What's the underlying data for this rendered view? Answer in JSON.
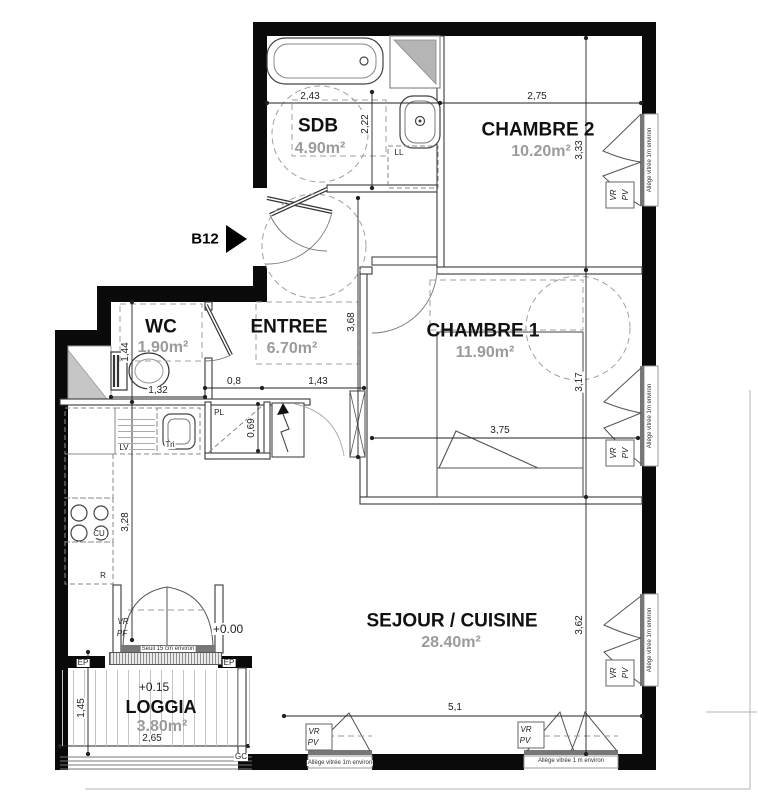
{
  "unit": {
    "label": "B12"
  },
  "rooms": {
    "sdb": {
      "name": "SDB",
      "area": "4.90m²"
    },
    "chambre2": {
      "name": "CHAMBRE 2",
      "area": "10.20m²"
    },
    "wc": {
      "name": "WC",
      "area": "1.90m²"
    },
    "entree": {
      "name": "ENTREE",
      "area": "6.70m²"
    },
    "chambre1": {
      "name": "CHAMBRE 1",
      "area": "11.90m²"
    },
    "sejour": {
      "name": "SEJOUR / CUISINE",
      "area": "28.40m²"
    },
    "loggia": {
      "name": "LOGGIA",
      "area": "3.80m²",
      "level": "+0.15"
    }
  },
  "levels": {
    "interior": "+0.00"
  },
  "dims": {
    "sdb_width": "2,43",
    "sdb_depth": "2,22",
    "ch2_width": "2,75",
    "ch2_depth": "3,33",
    "entree_depth": "3,68",
    "wc_depth": "1,44",
    "wc_width": "1,32",
    "pl_width": "0,8",
    "hall_width": "1,43",
    "pl_depth": "0,69",
    "ch1_width": "3,75",
    "ch1_depth": "3,17",
    "kitchen_depth": "3,28",
    "sejour_width": "5,1",
    "sejour_depth": "3,62",
    "loggia_depth": "1,45",
    "loggia_width": "2,65"
  },
  "equipment": {
    "washing_machine": "LL",
    "dishwasher": "LV",
    "sink": "Tri",
    "hob": "CU",
    "fridge": "R",
    "closet": "PL"
  },
  "window_labels": {
    "shutter": "VR",
    "french_door": "PF",
    "window": "PV"
  },
  "annotations": {
    "threshold": "Seuil 15 cm environ",
    "sill": "Allège vitrée 1m environ",
    "sill_alt": "Allège vitrée 1 m environ",
    "rainwater": "EP",
    "gc": "GC"
  }
}
